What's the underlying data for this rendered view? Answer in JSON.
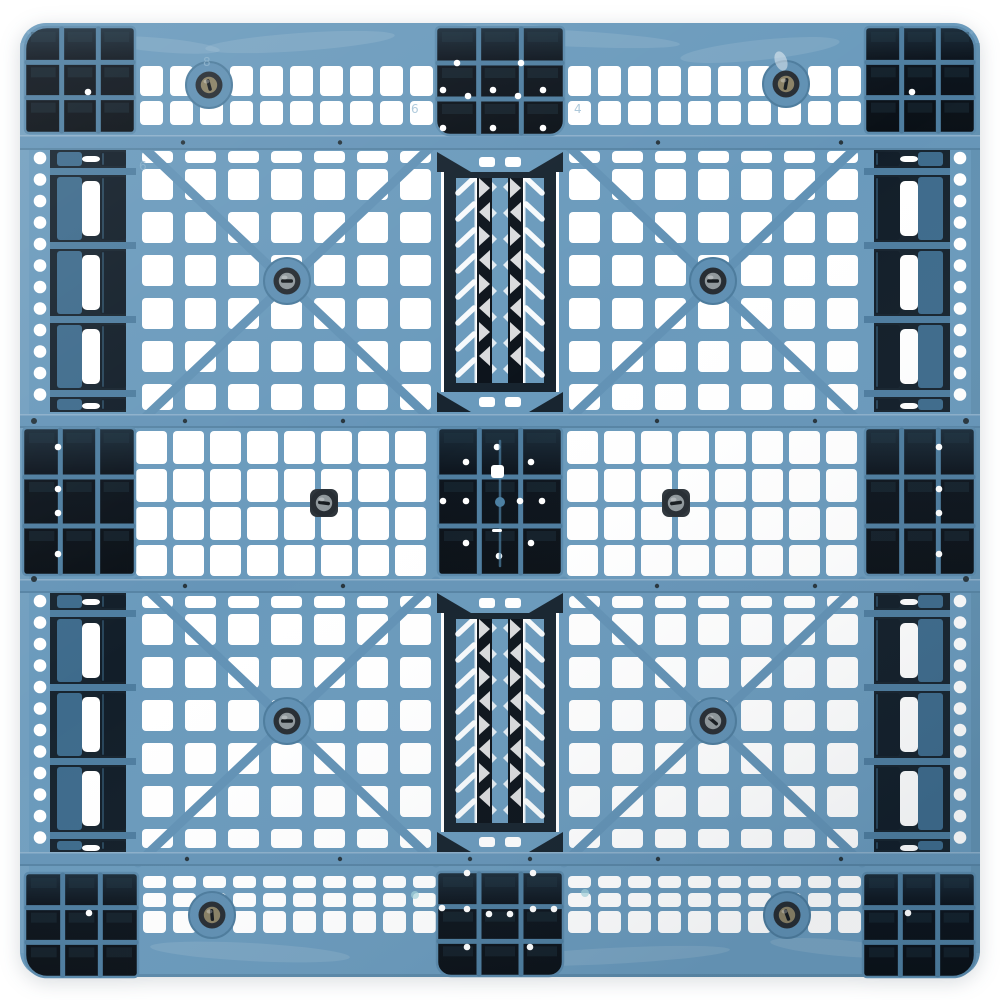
{
  "meta": {
    "type": "product-photo",
    "subject": "blue plastic pallet, top view",
    "background": "#ffffff",
    "screw_count": 10,
    "block_count": 9,
    "block_grid": "3x3"
  },
  "palette": {
    "bg": "#ffffff",
    "base": "#6a9abc",
    "baseLight": "#7ca6c4",
    "rail": "#6695b8",
    "railEdge": "#54809f",
    "brace": "#6292b5",
    "boss": "#6090b3",
    "bossEdge": "#4d7c9d",
    "steel": "#3e6b8c",
    "navy": "#17242f",
    "navy2": "#121e29",
    "black": "#0c131b",
    "divider": "#4e7d9f",
    "blockEdge": "#5b8aac",
    "cellHi": "#233949",
    "white": "#ffffff",
    "screwRing": "#272d33",
    "screwGray": "#90989c",
    "screwBronze": "#8a8165",
    "slot": "#171c20",
    "dotNavy": "#27353d",
    "paleCyan": "#a6d6de",
    "markBlue": "#8fb5ce",
    "squareBoss": "#2e353b",
    "centerTeal": "#4b7fa2"
  },
  "pallet": {
    "x": 20,
    "y": 23,
    "w": 960,
    "h": 954,
    "rx": 26
  },
  "mottle": [
    [
      300,
      42,
      95,
      9,
      -4
    ],
    [
      560,
      38,
      120,
      8,
      3
    ],
    [
      760,
      50,
      80,
      10,
      -6
    ],
    [
      160,
      45,
      60,
      7,
      5
    ],
    [
      500,
      30,
      60,
      6,
      0
    ],
    [
      250,
      952,
      100,
      9,
      3
    ],
    [
      610,
      956,
      120,
      8,
      -3
    ],
    [
      840,
      948,
      70,
      8,
      5
    ]
  ],
  "grids": [
    {
      "x0": 140,
      "cols": 10,
      "pitch": 30,
      "w": 23,
      "rows": [
        [
          66,
          30
        ],
        [
          101,
          24
        ]
      ]
    },
    {
      "x0": 568,
      "cols": 10,
      "pitch": 30,
      "w": 23,
      "rows": [
        [
          66,
          30
        ],
        [
          101,
          24
        ]
      ]
    },
    {
      "x0": 142,
      "cols": 7,
      "pitch": 43,
      "w": 31,
      "rows": [
        [
          151,
          12
        ],
        [
          169,
          31
        ],
        [
          212,
          31
        ],
        [
          255,
          31
        ],
        [
          298,
          31
        ],
        [
          341,
          31
        ],
        [
          384,
          26
        ]
      ]
    },
    {
      "x0": 569,
      "cols": 7,
      "pitch": 43,
      "w": 31,
      "rows": [
        [
          151,
          12
        ],
        [
          169,
          31
        ],
        [
          212,
          31
        ],
        [
          255,
          31
        ],
        [
          298,
          31
        ],
        [
          341,
          31
        ],
        [
          384,
          26
        ]
      ]
    },
    {
      "x0": 136,
      "cols": 8,
      "pitch": 37,
      "w": 31,
      "rows": [
        [
          431,
          33
        ],
        [
          469,
          33
        ],
        [
          507,
          33
        ],
        [
          545,
          31
        ]
      ]
    },
    {
      "x0": 567,
      "cols": 8,
      "pitch": 37,
      "w": 31,
      "rows": [
        [
          431,
          33
        ],
        [
          469,
          33
        ],
        [
          507,
          33
        ],
        [
          545,
          31
        ]
      ]
    },
    {
      "x0": 142,
      "cols": 7,
      "pitch": 43,
      "w": 31,
      "rows": [
        [
          596,
          12
        ],
        [
          614,
          31
        ],
        [
          657,
          31
        ],
        [
          700,
          31
        ],
        [
          743,
          31
        ],
        [
          786,
          31
        ],
        [
          829,
          19
        ]
      ]
    },
    {
      "x0": 569,
      "cols": 7,
      "pitch": 43,
      "w": 31,
      "rows": [
        [
          596,
          12
        ],
        [
          614,
          31
        ],
        [
          657,
          31
        ],
        [
          700,
          31
        ],
        [
          743,
          31
        ],
        [
          786,
          31
        ],
        [
          829,
          19
        ]
      ]
    },
    {
      "x0": 143,
      "cols": 10,
      "pitch": 30,
      "w": 23,
      "rows": [
        [
          876,
          12
        ],
        [
          893,
          14
        ],
        [
          911,
          22
        ]
      ]
    },
    {
      "x0": 568,
      "cols": 10,
      "pitch": 30,
      "w": 23,
      "rows": [
        [
          876,
          12
        ],
        [
          893,
          14
        ],
        [
          911,
          22
        ]
      ]
    }
  ],
  "edge_zones": [
    {
      "side": "left",
      "wall": [
        20,
        10
      ],
      "dotCx": 40,
      "stripes": {
        "darkRib": [
          50,
          7
        ],
        "colA": [
          57,
          25
        ],
        "white": [
          82,
          18
        ],
        "colC": [
          100,
          26
        ],
        "rib": [
          126,
          10
        ]
      },
      "bands": [
        {
          "y1": 150,
          "y2": 412,
          "div": [
            168,
            242,
            316,
            390
          ],
          "dot0": 158,
          "dotN": 12
        },
        {
          "y1": 593,
          "y2": 852,
          "div": [
            610,
            684,
            758,
            832
          ],
          "dot0": 601,
          "dotN": 12
        }
      ]
    },
    {
      "side": "right",
      "wall": [
        970,
        10
      ],
      "dotCx": 960,
      "stripes": {
        "darkRib": [
          943,
          7
        ],
        "colA": [
          918,
          25
        ],
        "white": [
          900,
          18
        ],
        "colC": [
          874,
          26
        ],
        "rib": [
          864,
          10
        ]
      },
      "bands": [
        {
          "y1": 150,
          "y2": 412,
          "div": [
            168,
            242,
            316,
            390
          ],
          "dot0": 158,
          "dotN": 12
        },
        {
          "y1": 593,
          "y2": 852,
          "div": [
            610,
            684,
            758,
            832
          ],
          "dot0": 601,
          "dotN": 12
        }
      ]
    }
  ],
  "rails": [
    {
      "y": 135,
      "h": 15,
      "dots": [
        183,
        340,
        658,
        841
      ]
    },
    {
      "y": 414,
      "h": 14,
      "dots": [
        185,
        343,
        657,
        815
      ]
    },
    {
      "y": 579,
      "h": 14,
      "dots": [
        185,
        343,
        657,
        815
      ]
    },
    {
      "y": 852,
      "h": 14,
      "dots": [
        187,
        340,
        470,
        530,
        658,
        841
      ]
    }
  ],
  "braces": {
    "width": 9,
    "lines": [
      [
        138,
        142,
        436,
        424
      ],
      [
        436,
        142,
        138,
        424
      ],
      [
        564,
        142,
        862,
        424
      ],
      [
        862,
        142,
        564,
        424
      ],
      [
        138,
        581,
        436,
        863
      ],
      [
        436,
        581,
        138,
        863
      ],
      [
        564,
        581,
        862,
        863
      ],
      [
        862,
        581,
        564,
        863
      ]
    ],
    "cornerHighlights": [
      [
        28,
        32,
        70,
        74
      ],
      [
        972,
        32,
        930,
        74
      ],
      [
        28,
        968,
        70,
        926
      ],
      [
        972,
        968,
        930,
        926
      ]
    ]
  },
  "trusses": [
    {
      "top": 152,
      "bottom": 412
    },
    {
      "top": 593,
      "bottom": 852
    }
  ],
  "truss_layout": {
    "x": 437,
    "w": 126,
    "endH": 20,
    "slits": [
      441,
      556
    ],
    "bars": [
      [
        444,
        12
      ],
      [
        544,
        12
      ]
    ],
    "slashRibs": [
      [
        456,
        20
      ],
      [
        524,
        20
      ]
    ],
    "ladders": [
      [
        477,
        15
      ],
      [
        508,
        15
      ]
    ],
    "centerRib": [
      492,
      16
    ]
  },
  "blocks": [
    {
      "x": 25,
      "y": 27,
      "w": 110,
      "h": 106,
      "corner": "tl",
      "dots": [
        [
          88,
          92
        ]
      ]
    },
    {
      "x": 436,
      "y": 27,
      "w": 128,
      "h": 108,
      "corner": "bb",
      "dots": [
        [
          457,
          63
        ],
        [
          521,
          63
        ],
        [
          443,
          90
        ],
        [
          468,
          96
        ],
        [
          493,
          90
        ],
        [
          518,
          96
        ],
        [
          543,
          90
        ],
        [
          443,
          128
        ],
        [
          493,
          128
        ],
        [
          543,
          128
        ]
      ]
    },
    {
      "x": 865,
      "y": 27,
      "w": 110,
      "h": 106,
      "corner": "tr",
      "dots": [
        [
          912,
          92
        ]
      ]
    },
    {
      "x": 23,
      "y": 428,
      "w": 112,
      "h": 147,
      "corner": "none",
      "dots": [
        [
          58,
          447
        ],
        [
          58,
          489
        ],
        [
          58,
          513
        ],
        [
          58,
          554
        ]
      ]
    },
    {
      "x": 438,
      "y": 428,
      "w": 124,
      "h": 147,
      "corner": "none",
      "dots": [
        [
          497,
          447
        ],
        [
          466,
          462
        ],
        [
          531,
          462
        ],
        [
          443,
          501
        ],
        [
          466,
          501
        ],
        [
          520,
          501
        ],
        [
          542,
          501
        ],
        [
          466,
          543
        ],
        [
          531,
          543
        ],
        [
          499,
          556
        ]
      ]
    },
    {
      "x": 865,
      "y": 428,
      "w": 110,
      "h": 147,
      "corner": "none",
      "dots": [
        [
          939,
          447
        ],
        [
          939,
          489
        ],
        [
          939,
          513
        ],
        [
          939,
          554
        ]
      ]
    },
    {
      "x": 25,
      "y": 873,
      "w": 113,
      "h": 104,
      "corner": "bl",
      "dots": [
        [
          89,
          913
        ]
      ]
    },
    {
      "x": 437,
      "y": 872,
      "w": 126,
      "h": 104,
      "corner": "bb",
      "dots": [
        [
          467,
          873
        ],
        [
          533,
          873
        ],
        [
          442,
          908
        ],
        [
          467,
          909
        ],
        [
          489,
          914
        ],
        [
          510,
          914
        ],
        [
          533,
          909
        ],
        [
          554,
          909
        ],
        [
          467,
          947
        ],
        [
          530,
          947
        ]
      ]
    },
    {
      "x": 863,
      "y": 873,
      "w": 112,
      "h": 104,
      "corner": "br",
      "dots": [
        [
          908,
          913
        ]
      ]
    }
  ],
  "center_block_extras": {
    "square": [
      491,
      465,
      13,
      13
    ],
    "dash": [
      492,
      529,
      10,
      3
    ],
    "dot": [
      500,
      502
    ],
    "line": [
      500,
      441,
      500,
      566
    ]
  },
  "screws": [
    {
      "cx": 209,
      "cy": 85,
      "face": "bronze",
      "boss": "round",
      "slotAngle": 75
    },
    {
      "cx": 786,
      "cy": 84,
      "face": "bronze",
      "boss": "round",
      "slotAngle": 100
    },
    {
      "cx": 287,
      "cy": 281,
      "face": "gray",
      "boss": "round",
      "slotAngle": 0
    },
    {
      "cx": 713,
      "cy": 281,
      "face": "gray",
      "boss": "round",
      "slotAngle": 0
    },
    {
      "cx": 324,
      "cy": 503,
      "face": "gray",
      "boss": "square",
      "slotAngle": 8
    },
    {
      "cx": 676,
      "cy": 503,
      "face": "gray",
      "boss": "square",
      "slotAngle": -8
    },
    {
      "cx": 287,
      "cy": 721,
      "face": "gray",
      "boss": "round",
      "slotAngle": 0
    },
    {
      "cx": 713,
      "cy": 721,
      "face": "gray",
      "boss": "round",
      "slotAngle": 40
    },
    {
      "cx": 212,
      "cy": 915,
      "face": "bronze",
      "boss": "round",
      "slotAngle": 85
    },
    {
      "cx": 787,
      "cy": 915,
      "face": "bronze",
      "boss": "round",
      "slotAngle": 70
    }
  ],
  "wall_dots": [
    [
      34,
      421
    ],
    [
      34,
      579
    ],
    [
      966,
      421
    ],
    [
      966,
      579
    ]
  ],
  "pale_dots": [
    [
      415,
      895
    ],
    [
      585,
      893
    ]
  ],
  "highlight_blobs": [
    [
      781,
      61
    ]
  ],
  "markings": [
    {
      "t": "8",
      "x": 203,
      "y": 66
    },
    {
      "t": "6",
      "x": 411,
      "y": 113
    },
    {
      "t": "4",
      "x": 574,
      "y": 113
    },
    {
      "t": "6",
      "x": 139,
      "y": 170
    }
  ]
}
